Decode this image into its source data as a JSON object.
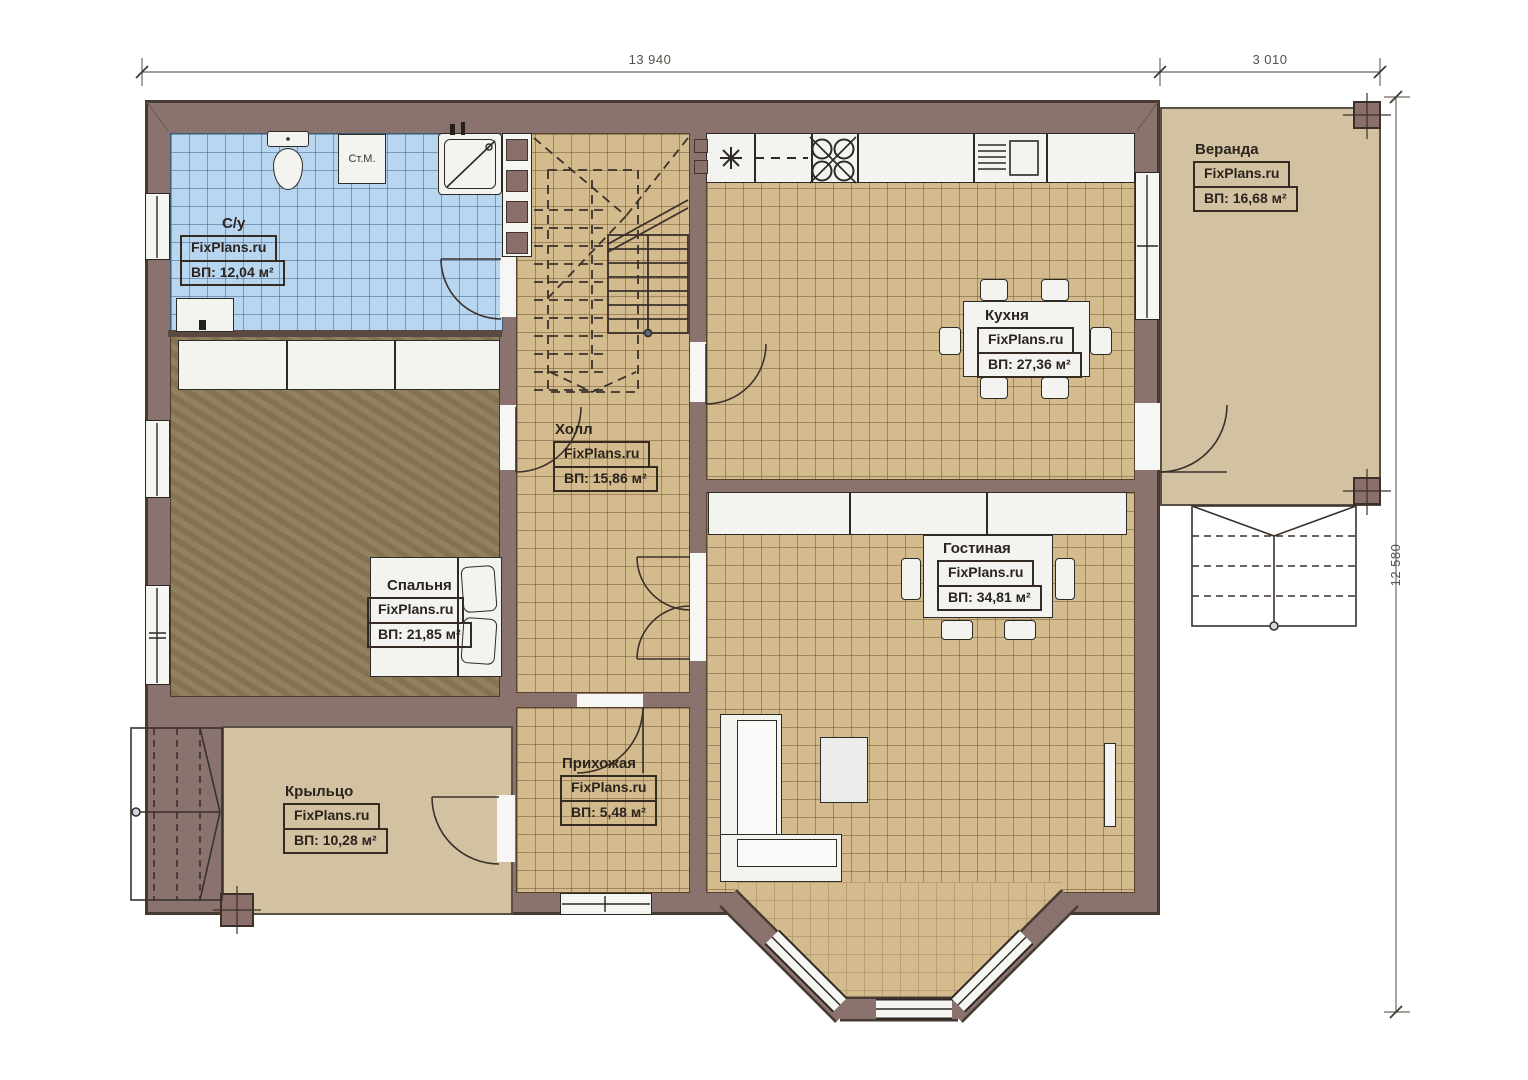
{
  "watermark": "FixPlans.ru",
  "dimensions": {
    "width_main": "13 940",
    "width_veranda": "3 010",
    "height_total": "12 580"
  },
  "rooms": [
    {
      "id": "bathroom",
      "name": "С/у",
      "area_label": "ВП: 12,04 м²"
    },
    {
      "id": "veranda",
      "name": "Веранда",
      "area_label": "ВП: 16,68 м²"
    },
    {
      "id": "kitchen",
      "name": "Кухня",
      "area_label": "ВП: 27,36 м²"
    },
    {
      "id": "hall",
      "name": "Холл",
      "area_label": "ВП: 15,86 м²"
    },
    {
      "id": "bedroom",
      "name": "Спальня",
      "area_label": "ВП: 21,85 м²"
    },
    {
      "id": "living_room",
      "name": "Гостиная",
      "area_label": "ВП: 34,81 м²"
    },
    {
      "id": "entry",
      "name": "Прихожая",
      "area_label": "ВП: 5,48 м²"
    },
    {
      "id": "porch",
      "name": "Крыльцо",
      "area_label": "ВП: 10,28 м²"
    }
  ],
  "labels": {
    "washing_machine": "Ст.М."
  },
  "colors": {
    "wall": "#8a726e",
    "tile_tan": "#d4bb8e",
    "tile_blue": "#b9d6f0",
    "floor_brown": "#8c7a56",
    "deck": "#d2c2a1",
    "outline": "#3b322c"
  }
}
